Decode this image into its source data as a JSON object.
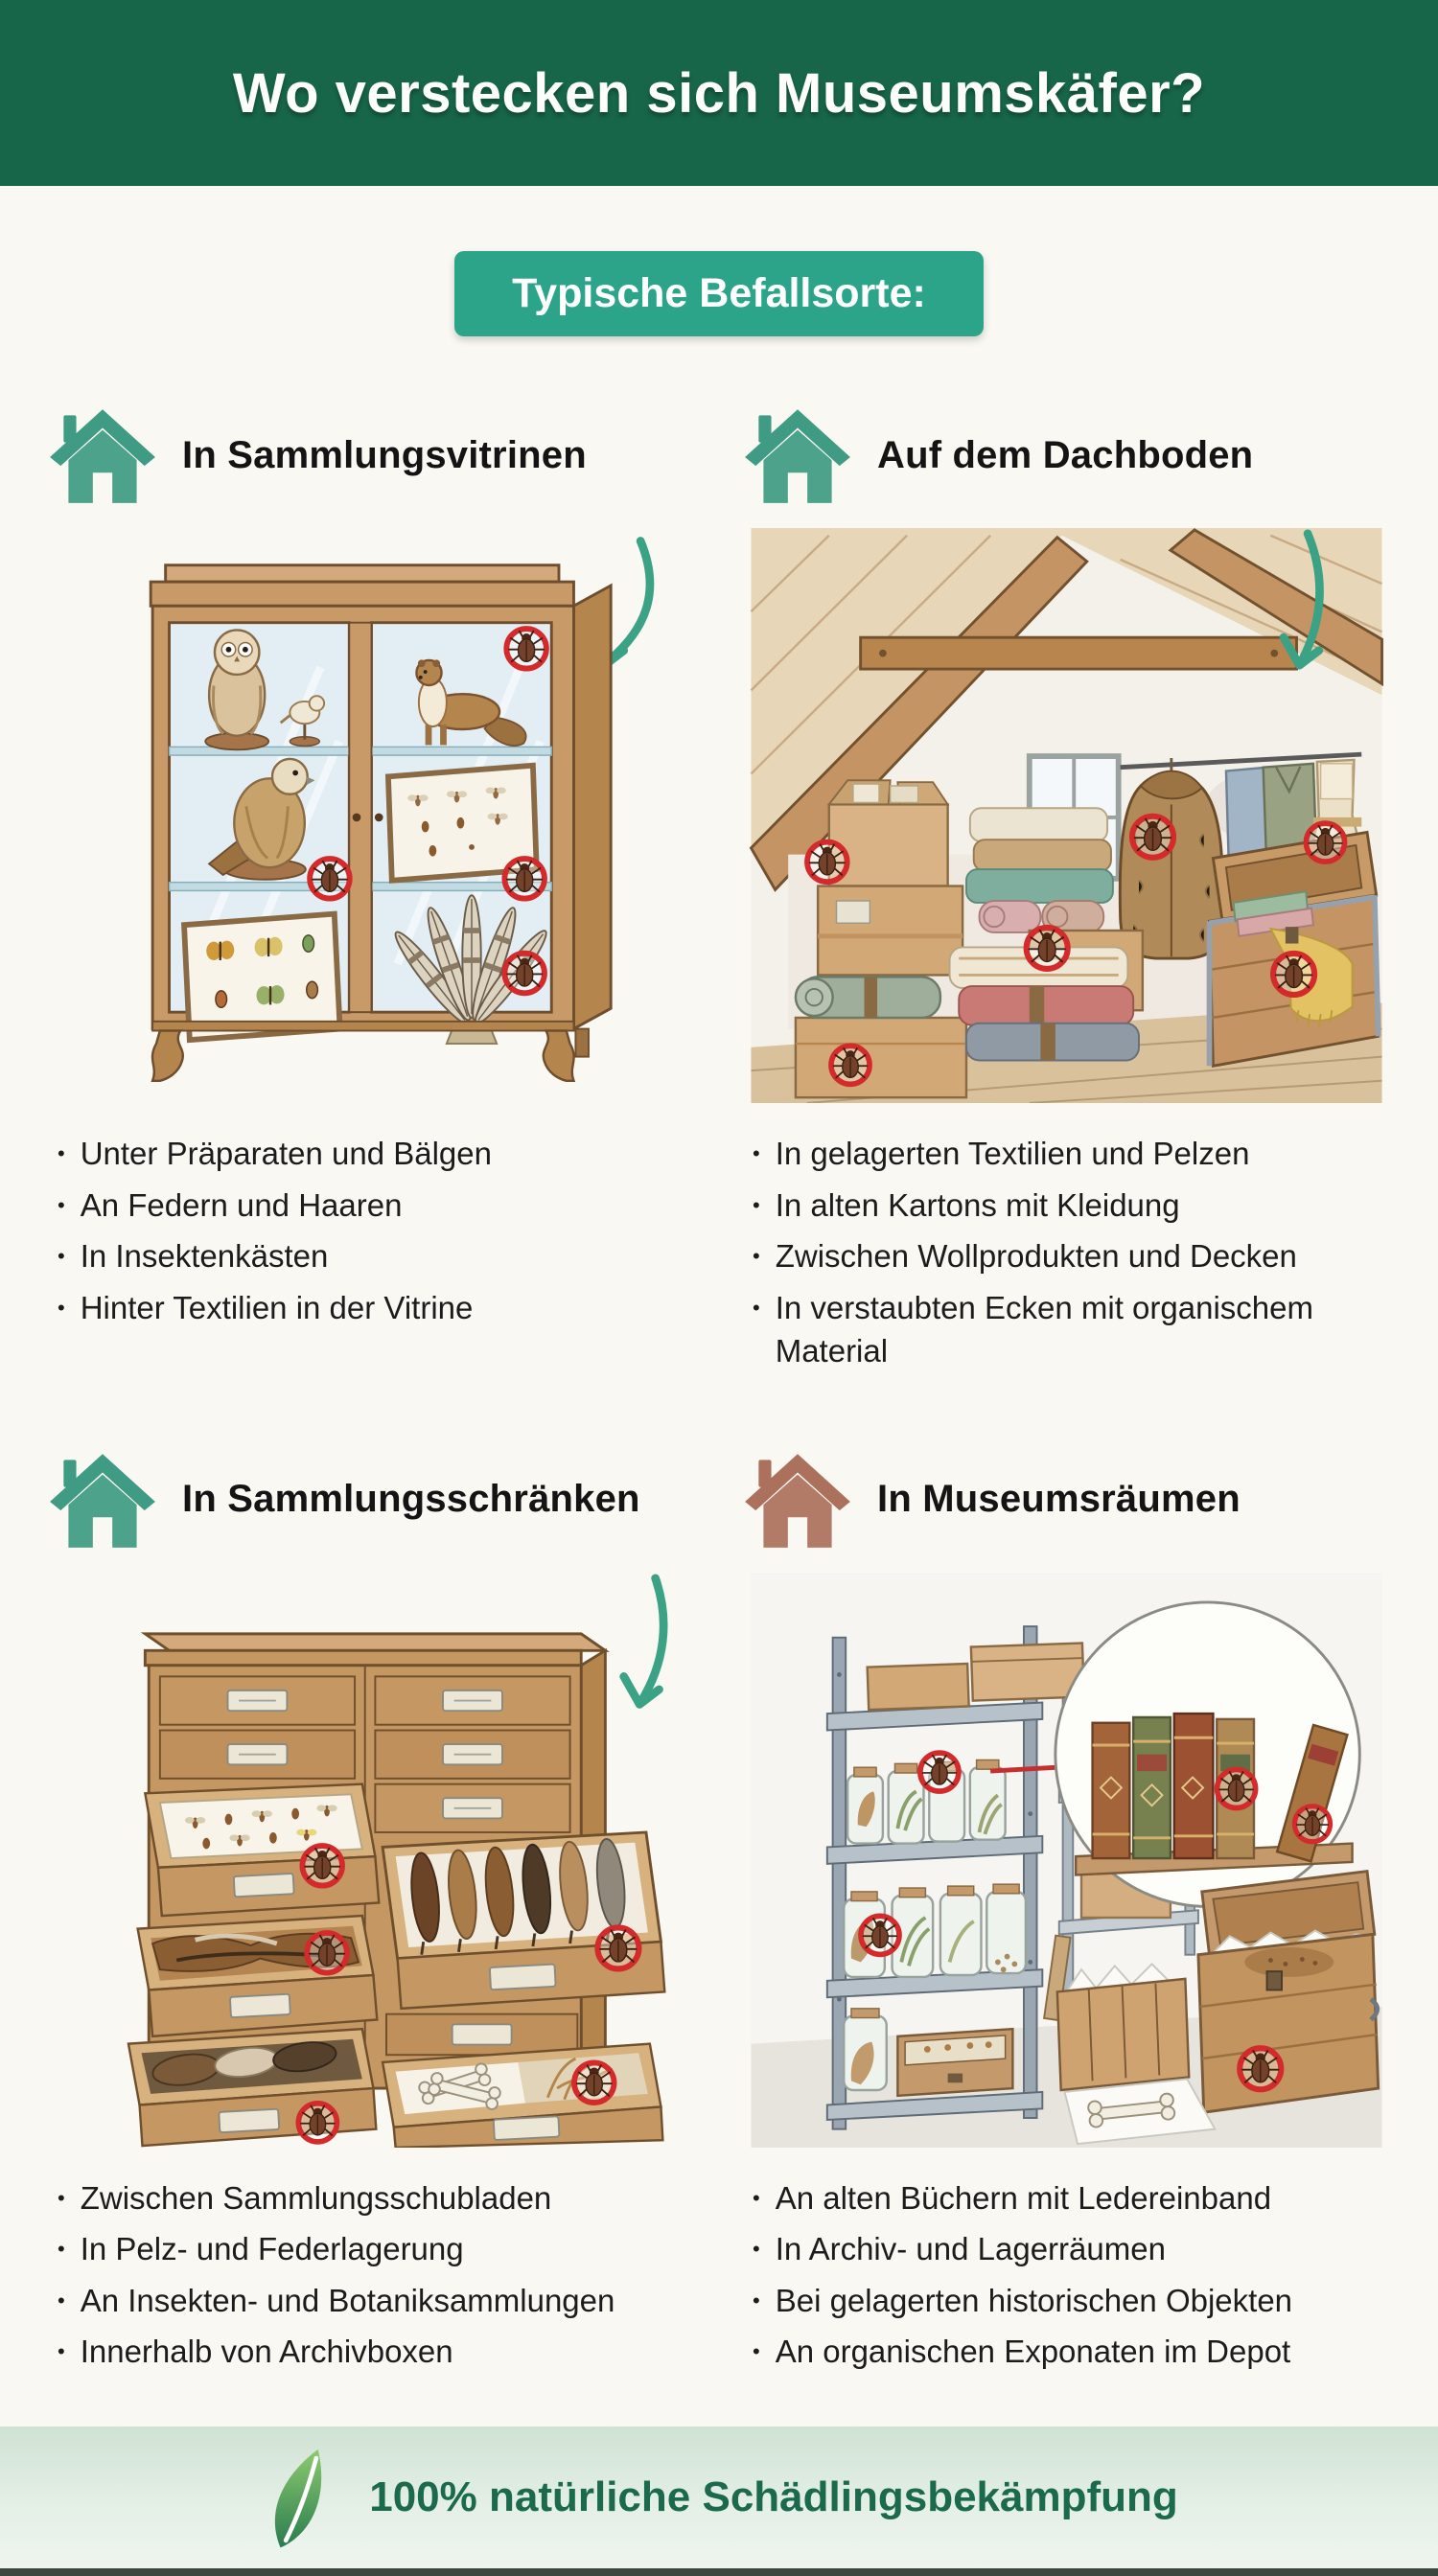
{
  "header": {
    "title": "Wo verstecken sich Museumskäfer?"
  },
  "badge": {
    "label": "Typische Befallsorte:"
  },
  "sections": [
    {
      "title": "In Sammlungsvitrinen",
      "icon": "house-icon",
      "illustration": "display-cabinet-with-taxidermy-and-insect-boxes",
      "bullets": [
        "Unter Präparaten und Bälgen",
        "An Federn und Haaren",
        "In Insektenkästen",
        "Hinter Textilien in der Vitrine"
      ]
    },
    {
      "title": "Auf dem Dachboden",
      "icon": "house-icon",
      "illustration": "attic-with-boxes-textiles-fur-coat-and-trunk",
      "bullets": [
        "In gelagerten Textilien und Pelzen",
        "In alten Kartons mit Kleidung",
        "Zwischen Wollprodukten und Decken",
        "In verstaubten Ecken mit organischem Material"
      ]
    },
    {
      "title": "In Sammlungsschränken",
      "icon": "house-icon",
      "illustration": "specimen-drawer-cabinet-with-insects-pelts-and-bones",
      "bullets": [
        "Zwischen Sammlungsschubladen",
        "In Pelz- und Federlagerung",
        "An Insekten- und Botaniksammlungen",
        "Innerhalb von Archivboxen"
      ]
    },
    {
      "title": "In Museumsräumen",
      "icon": "house-icon",
      "illustration": "storage-room-with-jar-shelves-old-books-and-crates",
      "bullets": [
        "An alten Büchern mit Ledereinband",
        "In Archiv- und Lagerräumen",
        "Bei gelagerten historischen Objekten",
        "An organischen Exponaten im Depot"
      ]
    }
  ],
  "footer": {
    "label": "100% natürliche Schädlingsbekämpfung",
    "icon": "leaf-icon"
  },
  "colors": {
    "header_bg": "#176649",
    "badge_bg": "#2ca48a",
    "accent_teal": "#3ba285",
    "house_teal": "#3f9b83",
    "house_brown": "#ac715c",
    "marker_red": "#d32b2b",
    "footer_text": "#1b6a4d"
  }
}
